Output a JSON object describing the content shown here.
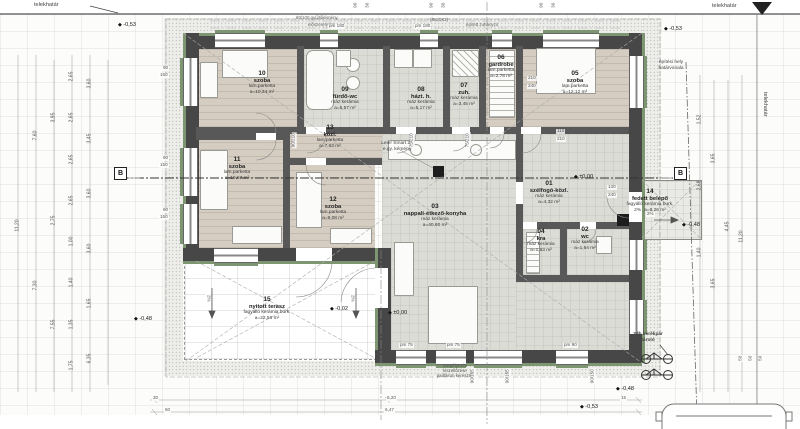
{
  "boundary": {
    "telekhatar_top_left": "telekhatár",
    "telekhatar_top_right": "telekhatár",
    "telekhatar_right_vertical": "telekhatár",
    "building_limit_line1": "építési hely",
    "building_limit_line2": "határvonala"
  },
  "rooms": [
    {
      "num": "01",
      "name": "szélfogó-közl.",
      "floor": "máz kerámia",
      "area": "a=4,32 m²"
    },
    {
      "num": "02",
      "name": "wc",
      "floor": "máz kerámia",
      "area": "a=1,54 m²"
    },
    {
      "num": "03",
      "name": "nappali-étkező-konyha",
      "floor": "máz kerámia",
      "area": "a=40,80 m²"
    },
    {
      "num": "04",
      "name": "kra",
      "floor": "máz kerámia",
      "area": "a=1,83 m²"
    },
    {
      "num": "05",
      "name": "szoba",
      "floor": "lam.parketta",
      "area": "a=12,12 m²"
    },
    {
      "num": "06",
      "name": "gardrobe",
      "floor": "lam.parketta",
      "area": "a=2,78 m²"
    },
    {
      "num": "07",
      "name": "zuh.",
      "floor": "máz kerámia",
      "area": "a=3,45 m²"
    },
    {
      "num": "08",
      "name": "házt. h.",
      "floor": "máz kerámia",
      "area": "a=5,17 m²"
    },
    {
      "num": "09",
      "name": "fürdő-wc",
      "floor": "máz kerámia",
      "area": "a=5,57 m²"
    },
    {
      "num": "10",
      "name": "szoba",
      "floor": "lam.parketta",
      "area": "a=10,34 m²"
    },
    {
      "num": "11",
      "name": "szoba",
      "floor": "lam.parketta",
      "area": "a=10,67 m²"
    },
    {
      "num": "12",
      "name": "szoba",
      "floor": "lam.parketta",
      "area": "a=9,08 m²"
    },
    {
      "num": "13",
      "name": "közl.",
      "floor": "lam.parketta",
      "area": "a=7,63 m²"
    },
    {
      "num": "14",
      "name": "fedett belépő",
      "floor": "fagyálló kerámia burk.",
      "area": "a=8,26 m²",
      "slope": "2%"
    },
    {
      "num": "15",
      "name": "nyitott terasz",
      "floor": "fagyálló kerámia burk.",
      "area": "a=22,56 m²"
    }
  ],
  "annotations": {
    "chimney_line1": "Leier Smart 20",
    "chimney_line2": "e.gy. kémény",
    "bike_line1": "2db kerékpár",
    "bike_line2": "tároló",
    "edge_note_line1": "szegélyezés",
    "edge_note_line2": "kiszellőzése",
    "edge_note_line3": "padláson keresztül",
    "top_note_1": "60/100 gyűjtőkémény",
    "top_note_2": "előszerelvény",
    "top_note_3": "(BU/1X2)",
    "top_note_4": "épített zuhanyzó",
    "section_label": "B"
  },
  "elevations": [
    {
      "t": "-0,53",
      "x": 118,
      "y": 22
    },
    {
      "t": "-0,53",
      "x": 664,
      "y": 26
    },
    {
      "t": "±0,00",
      "x": 574,
      "y": 174
    },
    {
      "t": "-0,48",
      "x": 682,
      "y": 222
    },
    {
      "t": "-0,02",
      "x": 330,
      "y": 306
    },
    {
      "t": "±0,00",
      "x": 388,
      "y": 310
    },
    {
      "t": "-0,48",
      "x": 134,
      "y": 316
    },
    {
      "t": "-0,48",
      "x": 616,
      "y": 386
    },
    {
      "t": "-0,53",
      "x": 580,
      "y": 404
    }
  ],
  "dims": {
    "left": [
      [
        "11,20"
      ],
      [
        "7,60",
        "7,30"
      ],
      [
        "3,95",
        "2,75",
        "7,55"
      ],
      [
        "2,65",
        "2,65",
        "2,65",
        "2,65",
        "1,00",
        "1,40",
        "1,35",
        "1,75"
      ],
      [
        "3,60",
        "3,45",
        "3,60",
        "3,60",
        "1,65",
        "6,35"
      ]
    ],
    "right": [
      [
        "1,52",
        "2,68",
        "1,40"
      ],
      [
        "3,65",
        "3,65"
      ],
      [
        "4,45"
      ],
      [
        "11,20"
      ]
    ]
  },
  "tiny_dims": [
    {
      "t": "90",
      "x": 352,
      "y": 3,
      "r": -90
    },
    {
      "t": "30",
      "x": 364,
      "y": 3,
      "r": -90
    },
    {
      "t": "90",
      "x": 428,
      "y": 3,
      "r": -90
    },
    {
      "t": "30",
      "x": 440,
      "y": 3,
      "r": -90
    },
    {
      "t": "90",
      "x": 538,
      "y": 3,
      "r": -90
    },
    {
      "t": "30",
      "x": 550,
      "y": 3,
      "r": -90
    },
    {
      "t": "pm 180",
      "x": 328,
      "y": 24
    },
    {
      "t": "pm 180",
      "x": 414,
      "y": 24
    },
    {
      "t": "90",
      "x": 162,
      "y": 66
    },
    {
      "t": "150",
      "x": 159,
      "y": 73
    },
    {
      "t": "90",
      "x": 162,
      "y": 156
    },
    {
      "t": "150",
      "x": 159,
      "y": 163
    },
    {
      "t": "90",
      "x": 162,
      "y": 208
    },
    {
      "t": "150",
      "x": 159,
      "y": 215
    },
    {
      "t": "210",
      "x": 527,
      "y": 76
    },
    {
      "t": "240",
      "x": 527,
      "y": 84
    },
    {
      "t": "110",
      "x": 556,
      "y": 129
    },
    {
      "t": "210",
      "x": 556,
      "y": 137
    },
    {
      "t": "130",
      "x": 607,
      "y": 185
    },
    {
      "t": "240",
      "x": 607,
      "y": 193
    },
    {
      "t": "90/210",
      "x": 286,
      "y": 138,
      "r": -90
    },
    {
      "t": "75/210",
      "x": 404,
      "y": 138,
      "r": -90
    },
    {
      "t": "75/210",
      "x": 460,
      "y": 138,
      "r": -90
    },
    {
      "t": "2%",
      "x": 204,
      "y": 296,
      "r": 90
    },
    {
      "t": "2%",
      "x": 348,
      "y": 296,
      "r": 90
    },
    {
      "t": "2%",
      "x": 646,
      "y": 212
    },
    {
      "t": "pm 75",
      "x": 399,
      "y": 343
    },
    {
      "t": "pm 75",
      "x": 446,
      "y": 343
    },
    {
      "t": "pm 90",
      "x": 563,
      "y": 343
    },
    {
      "t": "90/165",
      "x": 465,
      "y": 374,
      "r": -90
    },
    {
      "t": "90/165",
      "x": 500,
      "y": 374,
      "r": -90
    },
    {
      "t": "90/150",
      "x": 585,
      "y": 374,
      "r": -90
    },
    {
      "t": "30",
      "x": 152,
      "y": 396
    },
    {
      "t": "6,20",
      "x": 386,
      "y": 396
    },
    {
      "t": "15",
      "x": 620,
      "y": 396
    },
    {
      "t": "60",
      "x": 164,
      "y": 408
    },
    {
      "t": "6,47",
      "x": 384,
      "y": 408
    },
    {
      "t": "50",
      "x": 737,
      "y": 356,
      "r": -90
    },
    {
      "t": "50",
      "x": 747,
      "y": 356,
      "r": -90
    },
    {
      "t": "50",
      "x": 757,
      "y": 356,
      "r": -90
    }
  ]
}
